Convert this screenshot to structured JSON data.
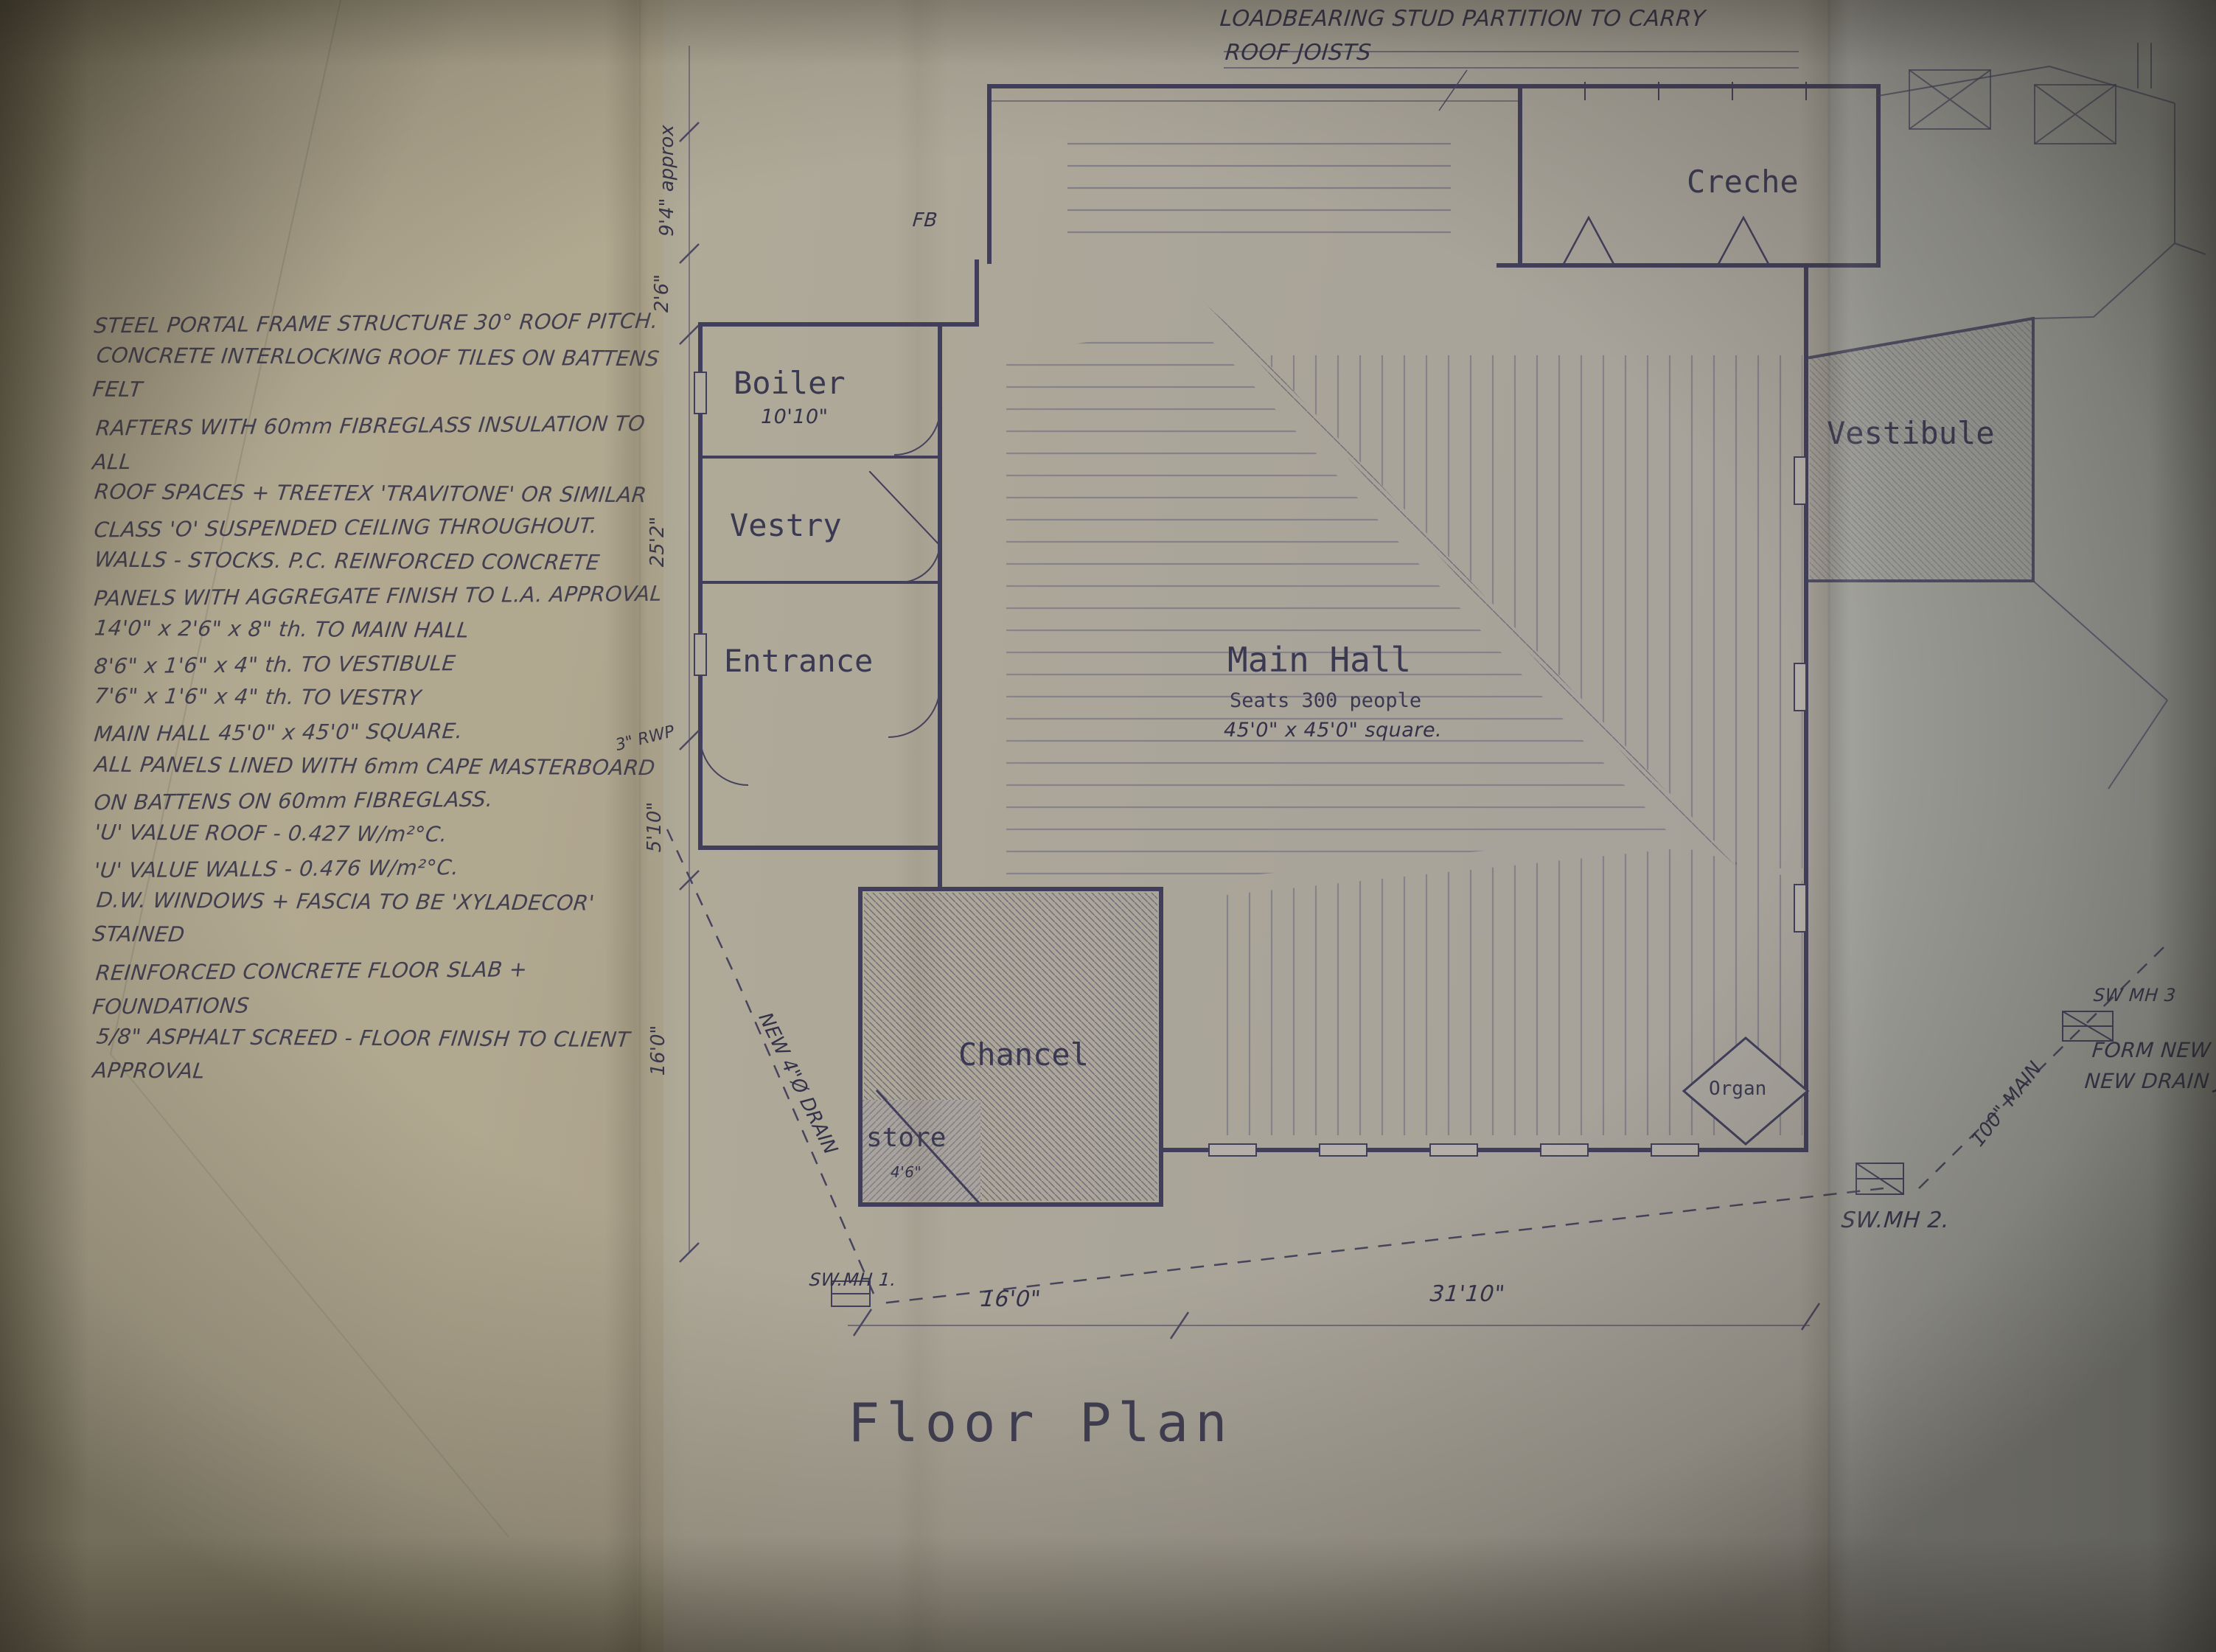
{
  "title": {
    "text": "Floor Plan"
  },
  "top_note": {
    "line1": "LOADBEARING STUD PARTITION TO CARRY",
    "line2": "ROOF JOISTS"
  },
  "specs_notes": {
    "lines": [
      "STEEL PORTAL FRAME STRUCTURE 30° ROOF PITCH.",
      "CONCRETE INTERLOCKING ROOF TILES ON BATTENS FELT",
      "RAFTERS WITH 60mm FIBREGLASS INSULATION TO ALL",
      "ROOF SPACES + TREETEX 'TRAVITONE' OR SIMILAR",
      "CLASS 'O' SUSPENDED CEILING THROUGHOUT.",
      "WALLS - STOCKS. P.C. REINFORCED CONCRETE",
      "PANELS WITH AGGREGATE FINISH TO L.A. APPROVAL",
      "14'0\" x 2'6\" x 8\" th. TO MAIN HALL",
      "8'6\" x 1'6\" x 4\" th. TO VESTIBULE",
      "7'6\" x 1'6\" x 4\" th. TO VESTRY",
      "MAIN HALL 45'0\" x 45'0\" SQUARE.",
      "ALL PANELS LINED WITH 6mm CAPE MASTERBOARD",
      "ON BATTENS ON 60mm FIBREGLASS.",
      "'U' VALUE ROOF - 0.427 W/m²°C.",
      "'U' VALUE WALLS - 0.476 W/m²°C.",
      "D.W. WINDOWS + FASCIA TO BE 'XYLADECOR' STAINED",
      "REINFORCED CONCRETE FLOOR SLAB + FOUNDATIONS",
      "5/8\" ASPHALT SCREED - FLOOR FINISH TO CLIENT APPROVAL"
    ]
  },
  "rooms": {
    "boiler": {
      "label": "Boiler",
      "size": "10'10\""
    },
    "vestry": {
      "label": "Vestry"
    },
    "entrance": {
      "label": "Entrance"
    },
    "main_hall": {
      "label": "Main Hall",
      "capacity": "Seats 300 people",
      "size": "45'0\" x 45'0\" square."
    },
    "creche": {
      "label": "Creche"
    },
    "vestibule": {
      "label": "Vestibule"
    },
    "chancel": {
      "label": "Chancel"
    },
    "store": {
      "label": "store",
      "size": "4'6\""
    },
    "organ": {
      "label": "Organ"
    }
  },
  "dimensions": {
    "bottom_16_0": "16'0\"",
    "bottom_31_10": "31'10\"",
    "left_9_4": "9'4\" approx",
    "left_2_6": "2'6\"",
    "left_25_2": "25'2\"",
    "left_5_10": "5'10\"",
    "left_16_0": "16'0\""
  },
  "annotations": {
    "mh1": "SW.MH 1.",
    "mh2": "SW.MH 2.",
    "mh3": "SW MH 3",
    "form_new_mh": "FORM NEW MH",
    "new_drain": "NEW DRAIN JO",
    "rwp": "3\" RWP",
    "main_100": "100\" MAIN",
    "new_drain_4": "NEW 4\"Ø DRAIN",
    "fb": "FB"
  },
  "colors": {
    "ink": "#413e5d",
    "paper_left": "#b2a88e",
    "paper_right": "#9a9b97",
    "hatch": "#4e4b72"
  }
}
